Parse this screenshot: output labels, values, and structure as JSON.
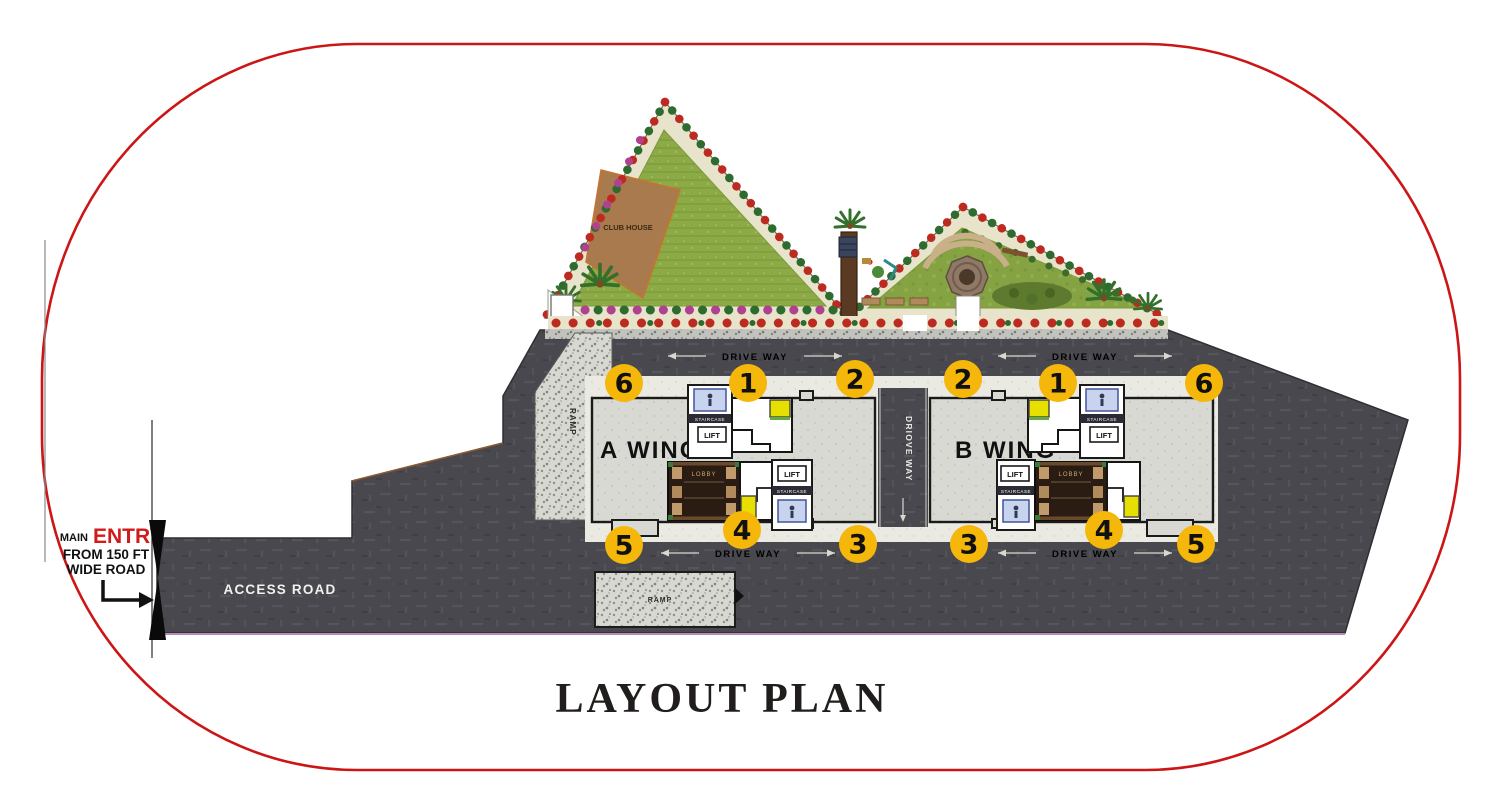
{
  "title": "LAYOUT PLAN",
  "entry": {
    "main": "MAIN",
    "entry": "ENTRY",
    "from": "FROM 150 FT",
    "wide": "WIDE ROAD"
  },
  "roads": {
    "access": "ACCESS ROAD",
    "drive_way_top_left": "DRIVE WAY",
    "drive_way_top_right": "DRIVE WAY",
    "drive_way_bottom_left": "DRIVE WAY",
    "drive_way_bottom_right": "DRIVE WAY",
    "center_drive_way": "DRIOVE WAY"
  },
  "ramps": {
    "side": "RAMP",
    "bottom": "RAMP"
  },
  "garden": {
    "club_house": "CLUB HOUSE"
  },
  "wings": {
    "a": {
      "label": "A WING",
      "top_badges": [
        "6",
        "1",
        "2"
      ],
      "bottom_badges": [
        "5",
        "4",
        "3"
      ]
    },
    "b": {
      "label": "B WING",
      "top_badges": [
        "2",
        "1",
        "6"
      ],
      "bottom_badges": [
        "3",
        "4",
        "5"
      ]
    }
  },
  "core": {
    "staircase": "STAIRCASE",
    "lift": "LIFT",
    "lobby": "LOBBY"
  },
  "colors": {
    "border_red": "#cc1515",
    "badge_yellow": "#f5b70a",
    "road_dark": "#48484e",
    "entry_red": "#d11a1a",
    "lawn_green": "#8caa45",
    "clubhouse_brown": "#a87a4e"
  }
}
